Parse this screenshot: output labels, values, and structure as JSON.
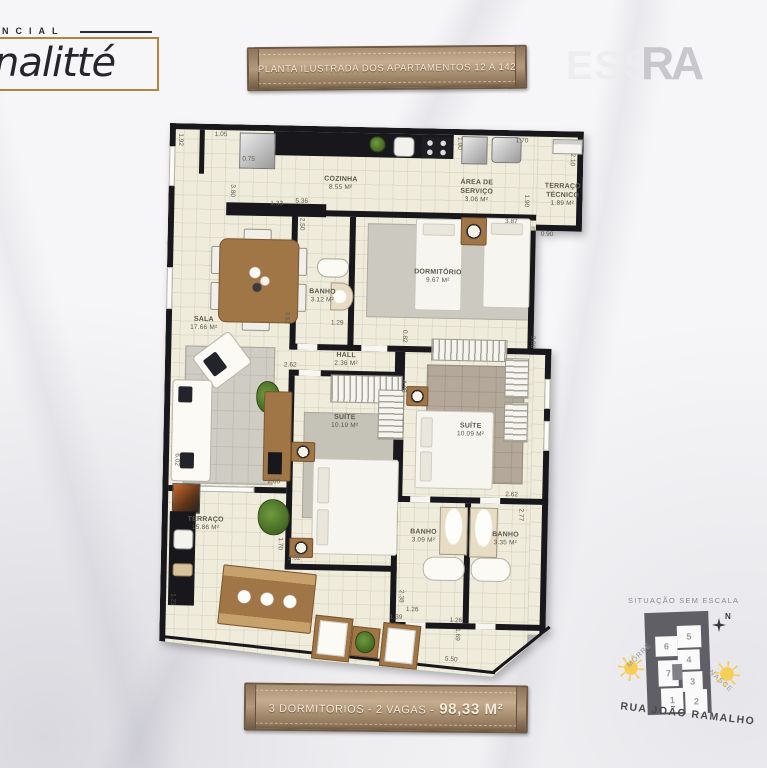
{
  "logo": {
    "brand_top": "NCIAL",
    "brand": "nalitté"
  },
  "header_plaque": {
    "text": "PLANTA ILUSTRADA DOS APARTAMENTOS 12 A 142"
  },
  "watermark": {
    "ess": "ESS",
    "r": "R",
    "a": "A"
  },
  "footer_plaque": {
    "left": "3 DORMITORIOS - 2 VAGAS -",
    "area": "98,33 M²"
  },
  "floorplan": {
    "rooms": [
      {
        "name": "COZINHA",
        "area": "8.55 m²"
      },
      {
        "name": "ÁREA DE SERVIÇO",
        "area": "3.06 m²"
      },
      {
        "name": "TERRAÇO TÉCNICO",
        "area": "1.89 m²"
      },
      {
        "name": "DORMITÓRIO",
        "area": "9.67 m²"
      },
      {
        "name": "BANHO",
        "area": "3.12 m²"
      },
      {
        "name": "SALA",
        "area": "17.66 m²"
      },
      {
        "name": "HALL",
        "area": "2.36 m²"
      },
      {
        "name": "SUÍTE",
        "area": "10.19 m²"
      },
      {
        "name": "SUÍTE",
        "area": "10.09 m²"
      },
      {
        "name": "TERRAÇO",
        "area": "15.86 m²"
      },
      {
        "name": "BANHO",
        "area": "3.09 m²"
      },
      {
        "name": "BANHO",
        "area": "3.35 m²"
      }
    ],
    "dims": [
      "1.92",
      "1.05",
      "0.75",
      "3.80",
      "1.33",
      "5.36",
      "2.50",
      "1.00",
      "1.70",
      "2.10",
      "1.90",
      "3.87",
      "0.90",
      "1.29",
      "3.62",
      "2.62",
      "0.82",
      "4.08",
      "3.08",
      "2.60",
      "1.70",
      "2.62",
      "2.62",
      "2.77",
      "2.38",
      "1.39",
      "1.26",
      "1.26",
      "1.69",
      "5.50",
      "1.21",
      "6.02"
    ]
  },
  "situation": {
    "title": "SITUAÇÃO SEM ESCALA",
    "street": "RUA JOÃO RAMALHO",
    "north": "N",
    "sun_left": "MORRE",
    "sun_right": "NASCE",
    "lots": [
      "1",
      "2",
      "3",
      "4",
      "5",
      "6",
      "7"
    ]
  }
}
